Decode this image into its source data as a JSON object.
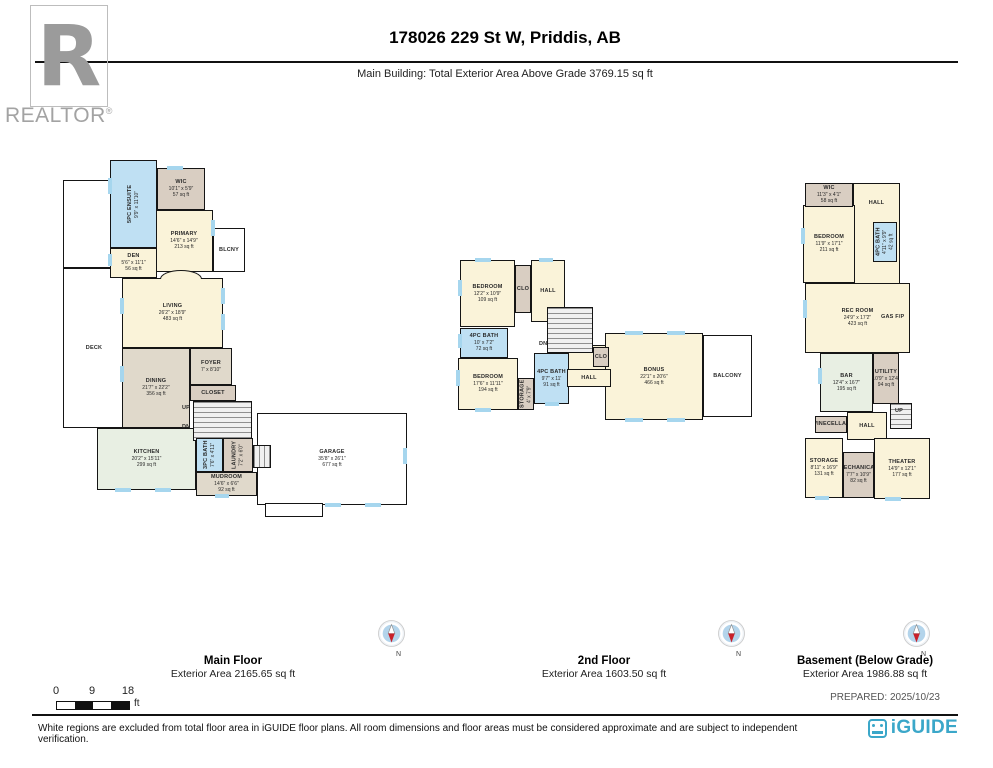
{
  "header": {
    "realtor_logo_letter": "R",
    "realtor_wordmark": "REALTOR",
    "registered_mark": "®",
    "title": "178026 229 St W, Priddis, AB",
    "subtitle": "Main Building: Total Exterior Area Above Grade 3769.15 sq ft"
  },
  "floors": {
    "main": {
      "name": "Main Floor",
      "area_label": "Exterior Area 2165.65 sq ft",
      "rooms": {
        "deck": {
          "label": "DECK"
        },
        "ensuite": {
          "label": "5PC ENSUITE",
          "dims": "9'9\" x 11'10\""
        },
        "wic": {
          "label": "WIC",
          "dims": "10'1\" x 5'9\"",
          "area": "57 sq ft"
        },
        "primary": {
          "label": "PRIMARY",
          "dims": "14'6\" x 14'9\"",
          "area": "213 sq ft"
        },
        "blcny": {
          "label": "BLCNY"
        },
        "den": {
          "label": "DEN",
          "dims": "5'6\" x 11'1\"",
          "area": "56 sq ft"
        },
        "living": {
          "label": "LIVING",
          "dims": "26'2\" x 18'9\"",
          "area": "483 sq ft"
        },
        "dining": {
          "label": "DINING",
          "dims": "21'7\" x 22'2\"",
          "area": "356 sq ft"
        },
        "foyer": {
          "label": "FOYER",
          "dims": "7' x 8'10\""
        },
        "closet": {
          "label": "CLOSET"
        },
        "kitchen": {
          "label": "KITCHEN",
          "dims": "20'2\" x 15'11\"",
          "area": "299 sq ft"
        },
        "bath": {
          "label": "3PC BATH",
          "dims": "7'6\" x 4'11\""
        },
        "laundry": {
          "label": "LAUNDRY",
          "dims": "7'2\" x 6'0\""
        },
        "mudroom": {
          "label": "MUDROOM",
          "dims": "14'6\" x 6'6\"",
          "area": "92 sq ft"
        },
        "garage": {
          "label": "GARAGE",
          "dims": "35'8\" x 26'1\"",
          "area": "677 sq ft"
        },
        "up": {
          "label": "UP"
        },
        "dn": {
          "label": "DN"
        }
      }
    },
    "second": {
      "name": "2nd Floor",
      "area_label": "Exterior Area 1603.50 sq ft",
      "rooms": {
        "bedroom1": {
          "label": "BEDROOM",
          "dims": "12'2\" x 10'9\"",
          "area": "109 sq ft"
        },
        "clo1": {
          "label": "CLO"
        },
        "hall1": {
          "label": "HALL"
        },
        "bath1": {
          "label": "4PC BATH",
          "dims": "10' x 7'2\"",
          "area": "72 sq ft"
        },
        "bedroom2": {
          "label": "BEDROOM",
          "dims": "17'6\" x 11'11\"",
          "area": "194 sq ft"
        },
        "storage": {
          "label": "STORAGE",
          "dims": "4' x 7'9\""
        },
        "bath2": {
          "label": "4PC BATH",
          "dims": "9'7\" x 11'",
          "area": "91 sq ft"
        },
        "clo2": {
          "label": "CLO"
        },
        "hall2": {
          "label": "HALL"
        },
        "dn": {
          "label": "DN"
        },
        "bonus": {
          "label": "BONUS",
          "dims": "22'1\" x 20'6\"",
          "area": "466 sq ft"
        },
        "balcony": {
          "label": "BALCONY"
        }
      }
    },
    "basement": {
      "name": "Basement (Below Grade)",
      "area_label": "Exterior Area 1986.88 sq ft",
      "rooms": {
        "wic": {
          "label": "WIC",
          "dims": "11'3\" x 4'1\"",
          "area": "58 sq ft"
        },
        "hall1": {
          "label": "HALL"
        },
        "bedroom": {
          "label": "BEDROOM",
          "dims": "11'9\" x 17'1\"",
          "area": "211 sq ft"
        },
        "bath": {
          "label": "4PC BATH",
          "dims": "4'11\" x 9'9\"",
          "area": "42 sq ft"
        },
        "rec": {
          "label": "REC ROOM",
          "dims": "24'9\" x 17'2\"",
          "area": "423 sq ft"
        },
        "gasfp": {
          "label": "GAS F/P"
        },
        "bar": {
          "label": "BAR",
          "dims": "12'4\" x 16'7\"",
          "area": "195 sq ft"
        },
        "utility": {
          "label": "UTILITY",
          "dims": "10'9\" x 12'4\"",
          "area": "94 sq ft"
        },
        "winecellar": {
          "label": "WINECELLAR"
        },
        "hall2": {
          "label": "HALL"
        },
        "up": {
          "label": "UP"
        },
        "storage": {
          "label": "STORAGE",
          "dims": "8'11\" x 16'9\"",
          "area": "131 sq ft"
        },
        "mechanical": {
          "label": "MECHANICAL",
          "dims": "7'7\" x 10'9\"",
          "area": "82 sq ft"
        },
        "theater": {
          "label": "THEATER",
          "dims": "14'9\" x 12'1\"",
          "area": "177 sq ft"
        }
      }
    }
  },
  "compass": {
    "n": "N"
  },
  "scale_bar": {
    "tick0": "0",
    "tick9": "9",
    "tick18": "18",
    "unit": "ft"
  },
  "prepared": "PREPARED: 2025/10/23",
  "footer": {
    "disclaimer": "White regions are excluded from total floor area in iGUIDE floor plans. All room dimensions and floor areas must be considered approximate and are subject to independent verification.",
    "brand": "iGUIDE"
  }
}
